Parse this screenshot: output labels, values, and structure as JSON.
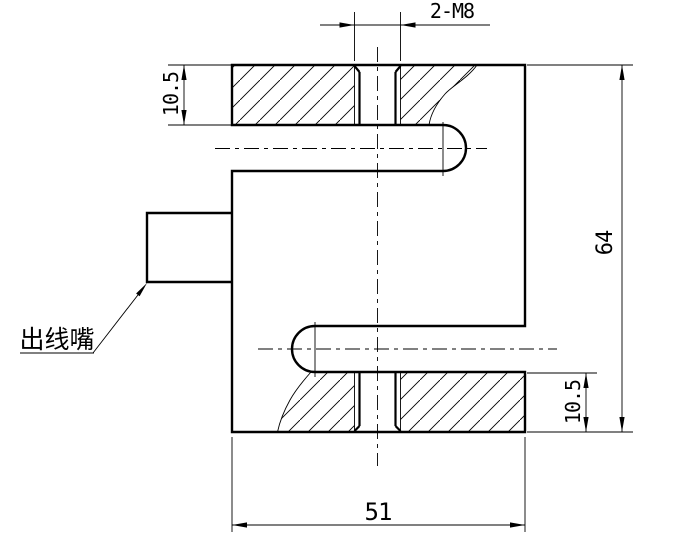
{
  "drawing": {
    "background": "#ffffff",
    "line_color": "#000000"
  },
  "dimensions": {
    "thread_callout": {
      "label": "2-M8"
    },
    "top_plate_thickness": {
      "label": "10.5"
    },
    "overall_height": {
      "label": "64"
    },
    "bottom_plate_thickness": {
      "label": "10.5"
    },
    "overall_width": {
      "label": "51"
    }
  },
  "callouts": {
    "cable_outlet": {
      "label": "出线嘴"
    }
  }
}
